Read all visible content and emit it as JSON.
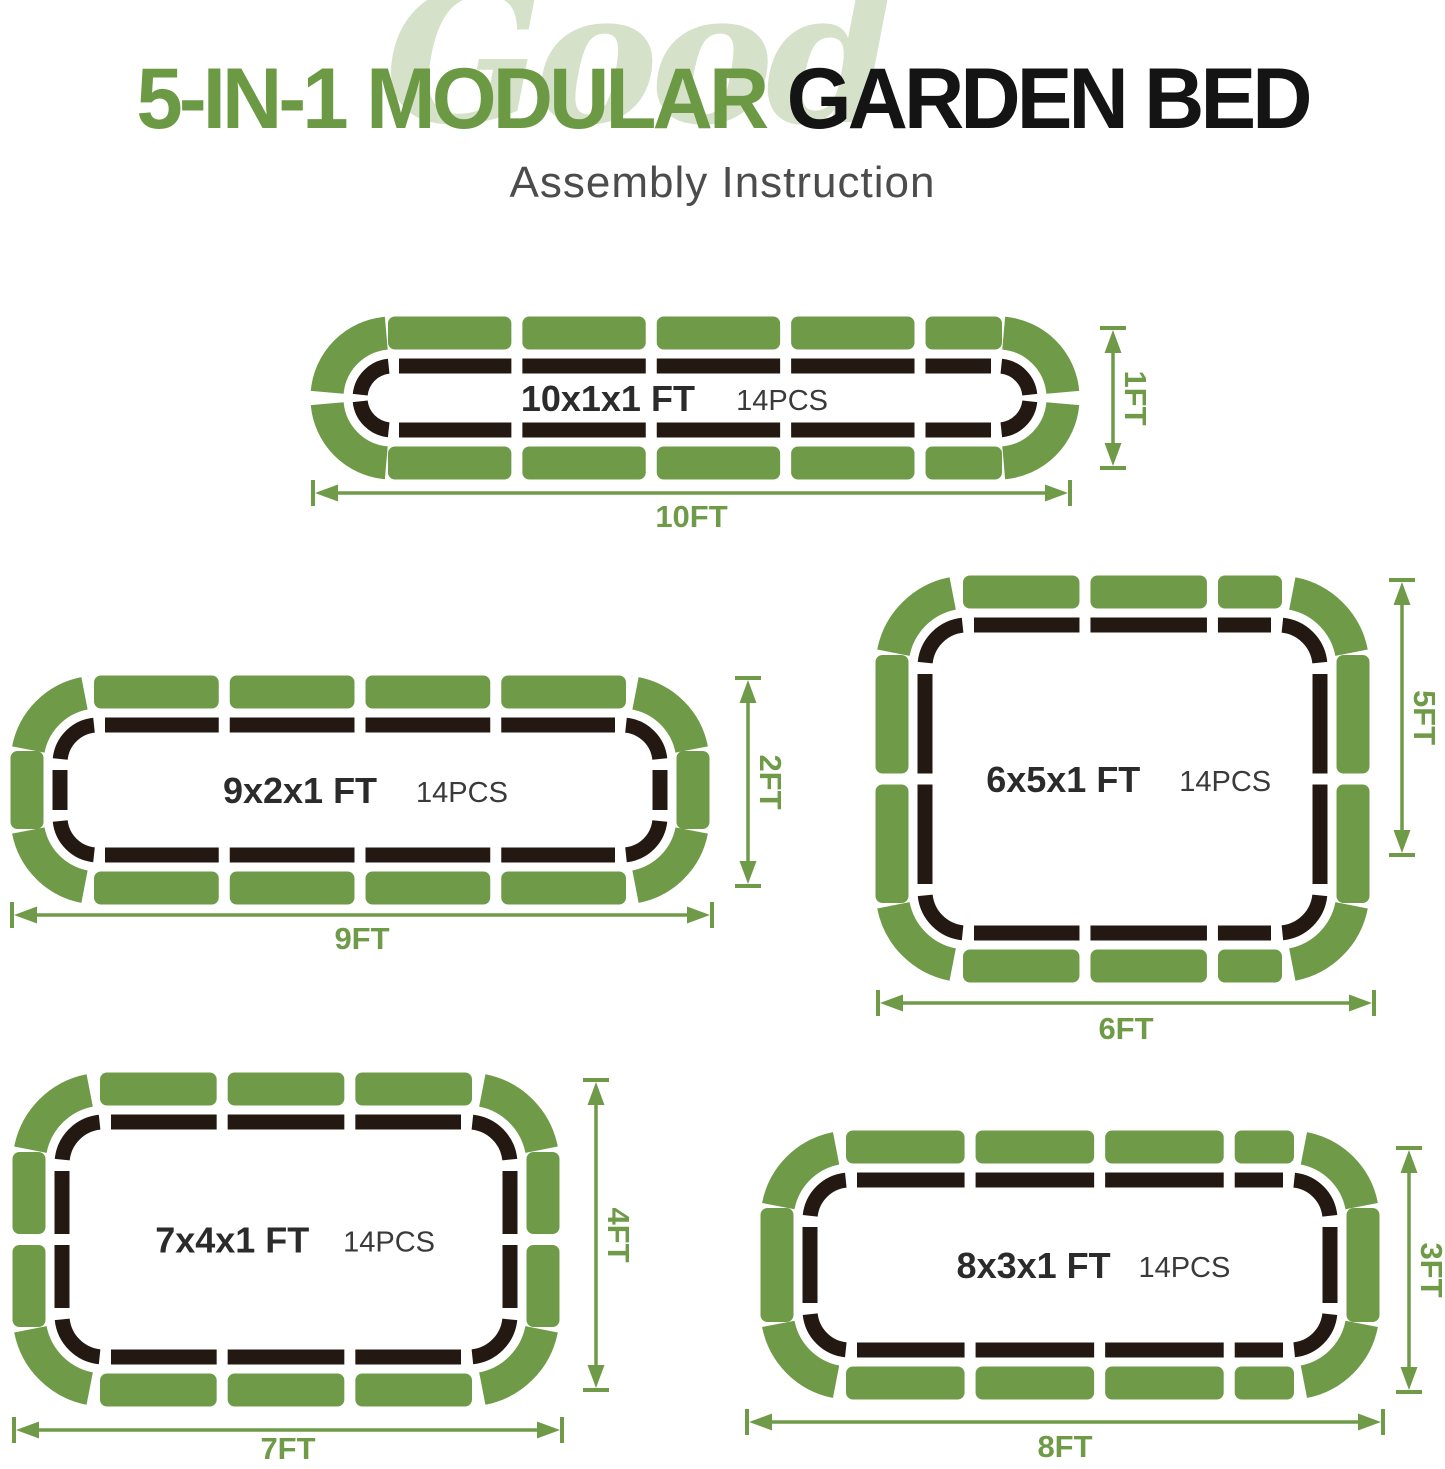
{
  "title": {
    "watermark": "Good",
    "part1": "5-IN-1",
    "part2": "MODULAR",
    "part3": "GARDEN BED",
    "subtitle": "Assembly Instruction"
  },
  "colors": {
    "green": "#6f9b49",
    "title_green": "#6c9a44",
    "watermark_green": "#d6e1c9",
    "frame_black": "#231812",
    "title_black": "#141414",
    "subtitle_gray": "#4c4c4c",
    "label_dark": "#2b2b2b",
    "label_gray": "#3a3a3a"
  },
  "beds": [
    {
      "label": "10x1x1 FT",
      "pcs": "14PCS",
      "width_ft": 10,
      "height_ft": 1,
      "depth_ft": 1,
      "width_label": "10FT",
      "height_label": "1FT",
      "pieces": {
        "top": 5,
        "bottom": 5,
        "left": 0,
        "right": 0,
        "corners": 4,
        "total": 14
      }
    },
    {
      "label": "9x2x1 FT",
      "pcs": "14PCS",
      "width_ft": 9,
      "height_ft": 2,
      "depth_ft": 1,
      "width_label": "9FT",
      "height_label": "2FT",
      "pieces": {
        "top": 4,
        "bottom": 4,
        "left": 1,
        "right": 1,
        "corners": 4,
        "total": 14
      }
    },
    {
      "label": "6x5x1 FT",
      "pcs": "14PCS",
      "width_ft": 6,
      "height_ft": 5,
      "depth_ft": 1,
      "width_label": "6FT",
      "height_label": "5FT",
      "pieces": {
        "top": 3,
        "bottom": 3,
        "left": 2,
        "right": 2,
        "corners": 4,
        "total": 14
      }
    },
    {
      "label": "7x4x1 FT",
      "pcs": "14PCS",
      "width_ft": 7,
      "height_ft": 4,
      "depth_ft": 1,
      "width_label": "7FT",
      "height_label": "4FT",
      "pieces": {
        "top": 3,
        "bottom": 3,
        "left": 2,
        "right": 2,
        "corners": 4,
        "total": 14
      }
    },
    {
      "label": "8x3x1 FT",
      "pcs": "14PCS",
      "width_ft": 8,
      "height_ft": 3,
      "depth_ft": 1,
      "width_label": "8FT",
      "height_label": "3FT",
      "pieces": {
        "top": 4,
        "bottom": 4,
        "left": 1,
        "right": 1,
        "corners": 4,
        "total": 14
      }
    }
  ]
}
